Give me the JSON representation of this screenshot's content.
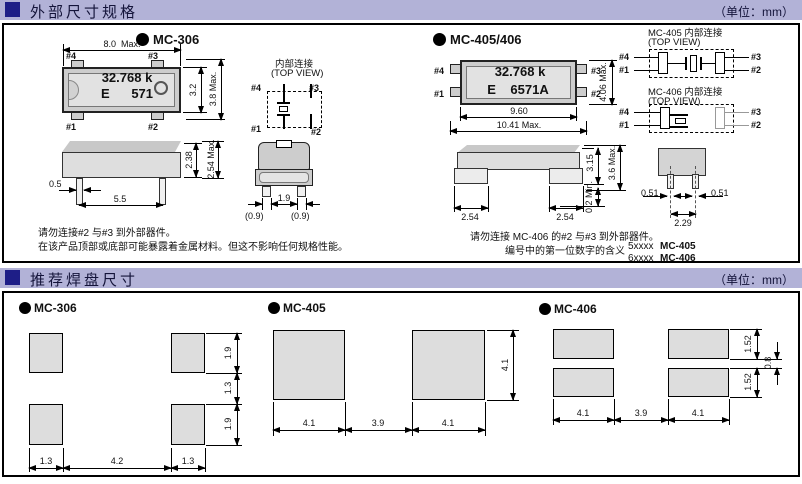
{
  "section_outer": {
    "title": "外部尺寸规格",
    "unit": "（单位：mm）"
  },
  "section_pads": {
    "title": "推荐焊盘尺寸",
    "unit": "（单位：mm）"
  },
  "mc306": {
    "name": "MC-306",
    "marking_line1": "32.768 k",
    "marking_line2": "E      571",
    "pins": {
      "p1": "#1",
      "p2": "#2",
      "p3": "#3",
      "p4": "#4"
    },
    "internal": {
      "title": "内部连接",
      "subtitle": "(TOP VIEW)"
    },
    "dims": {
      "body_width": "8.0  Max.",
      "body_height": "3.2",
      "overall_height": "3.8 Max.",
      "side_body_height": "2.38",
      "side_overall_height": "2.54 Max.",
      "lead_width": "0.5",
      "lead_pitch": "5.5",
      "end_lead_span": "1.9",
      "end_left": "(0.9)",
      "end_right": "(0.9)"
    },
    "note1": "请勿连接#2 与#3 到外部器件。",
    "note2": "在该产品顶部或底部可能暴露着金属材料。但这不影响任何规格性能。"
  },
  "mc405406": {
    "name": "MC-405/406",
    "marking_line1": "32.768 k",
    "marking_line2": "E    6571A",
    "pins": {
      "p1": "#1",
      "p2": "#2",
      "p3": "#3",
      "p4": "#4"
    },
    "internal405": {
      "title": "MC-405 内部连接",
      "subtitle": "(TOP VIEW)"
    },
    "internal406": {
      "title": "MC-406 内部连接",
      "subtitle": "(TOP VIEW)"
    },
    "dims": {
      "body_width": "9.60",
      "overall_width": "10.41 Max.",
      "overall_height": "4.06 Max.",
      "side_body_height": "3.15",
      "side_overall_height": "3.6 Max.",
      "standoff": "0.2 Min.",
      "foot_left": "2.54",
      "foot_right": "2.54",
      "lead_left": "0.51",
      "lead_right": "0.51",
      "lead_pitch": "2.29"
    },
    "note1": "请勿连接 MC-406 的#2 与#3 到外部器件。",
    "note2": "编号中的第一位数字的含义",
    "numbering": [
      {
        "code": "5xxxx",
        "model": "MC-405"
      },
      {
        "code": "6xxxx",
        "model": "MC-406"
      }
    ]
  },
  "pads306": {
    "name": "MC-306",
    "pad_height_top": "1.9",
    "row_gap": "1.3",
    "pad_height_bottom": "1.9",
    "pad_width_left": "1.3",
    "column_gap": "4.2",
    "pad_width_right": "1.3"
  },
  "pads405": {
    "name": "MC-405",
    "pad_width_left": "4.1",
    "gap": "3.9",
    "pad_width_right": "4.1",
    "pad_height": "4.1"
  },
  "pads406": {
    "name": "MC-406",
    "pad_width_left": "4.1",
    "gap": "3.9",
    "pad_width_right": "4.1",
    "pad_height_top": "1.52",
    "pad_height_bottom": "1.52",
    "row_gap": "0.8"
  }
}
